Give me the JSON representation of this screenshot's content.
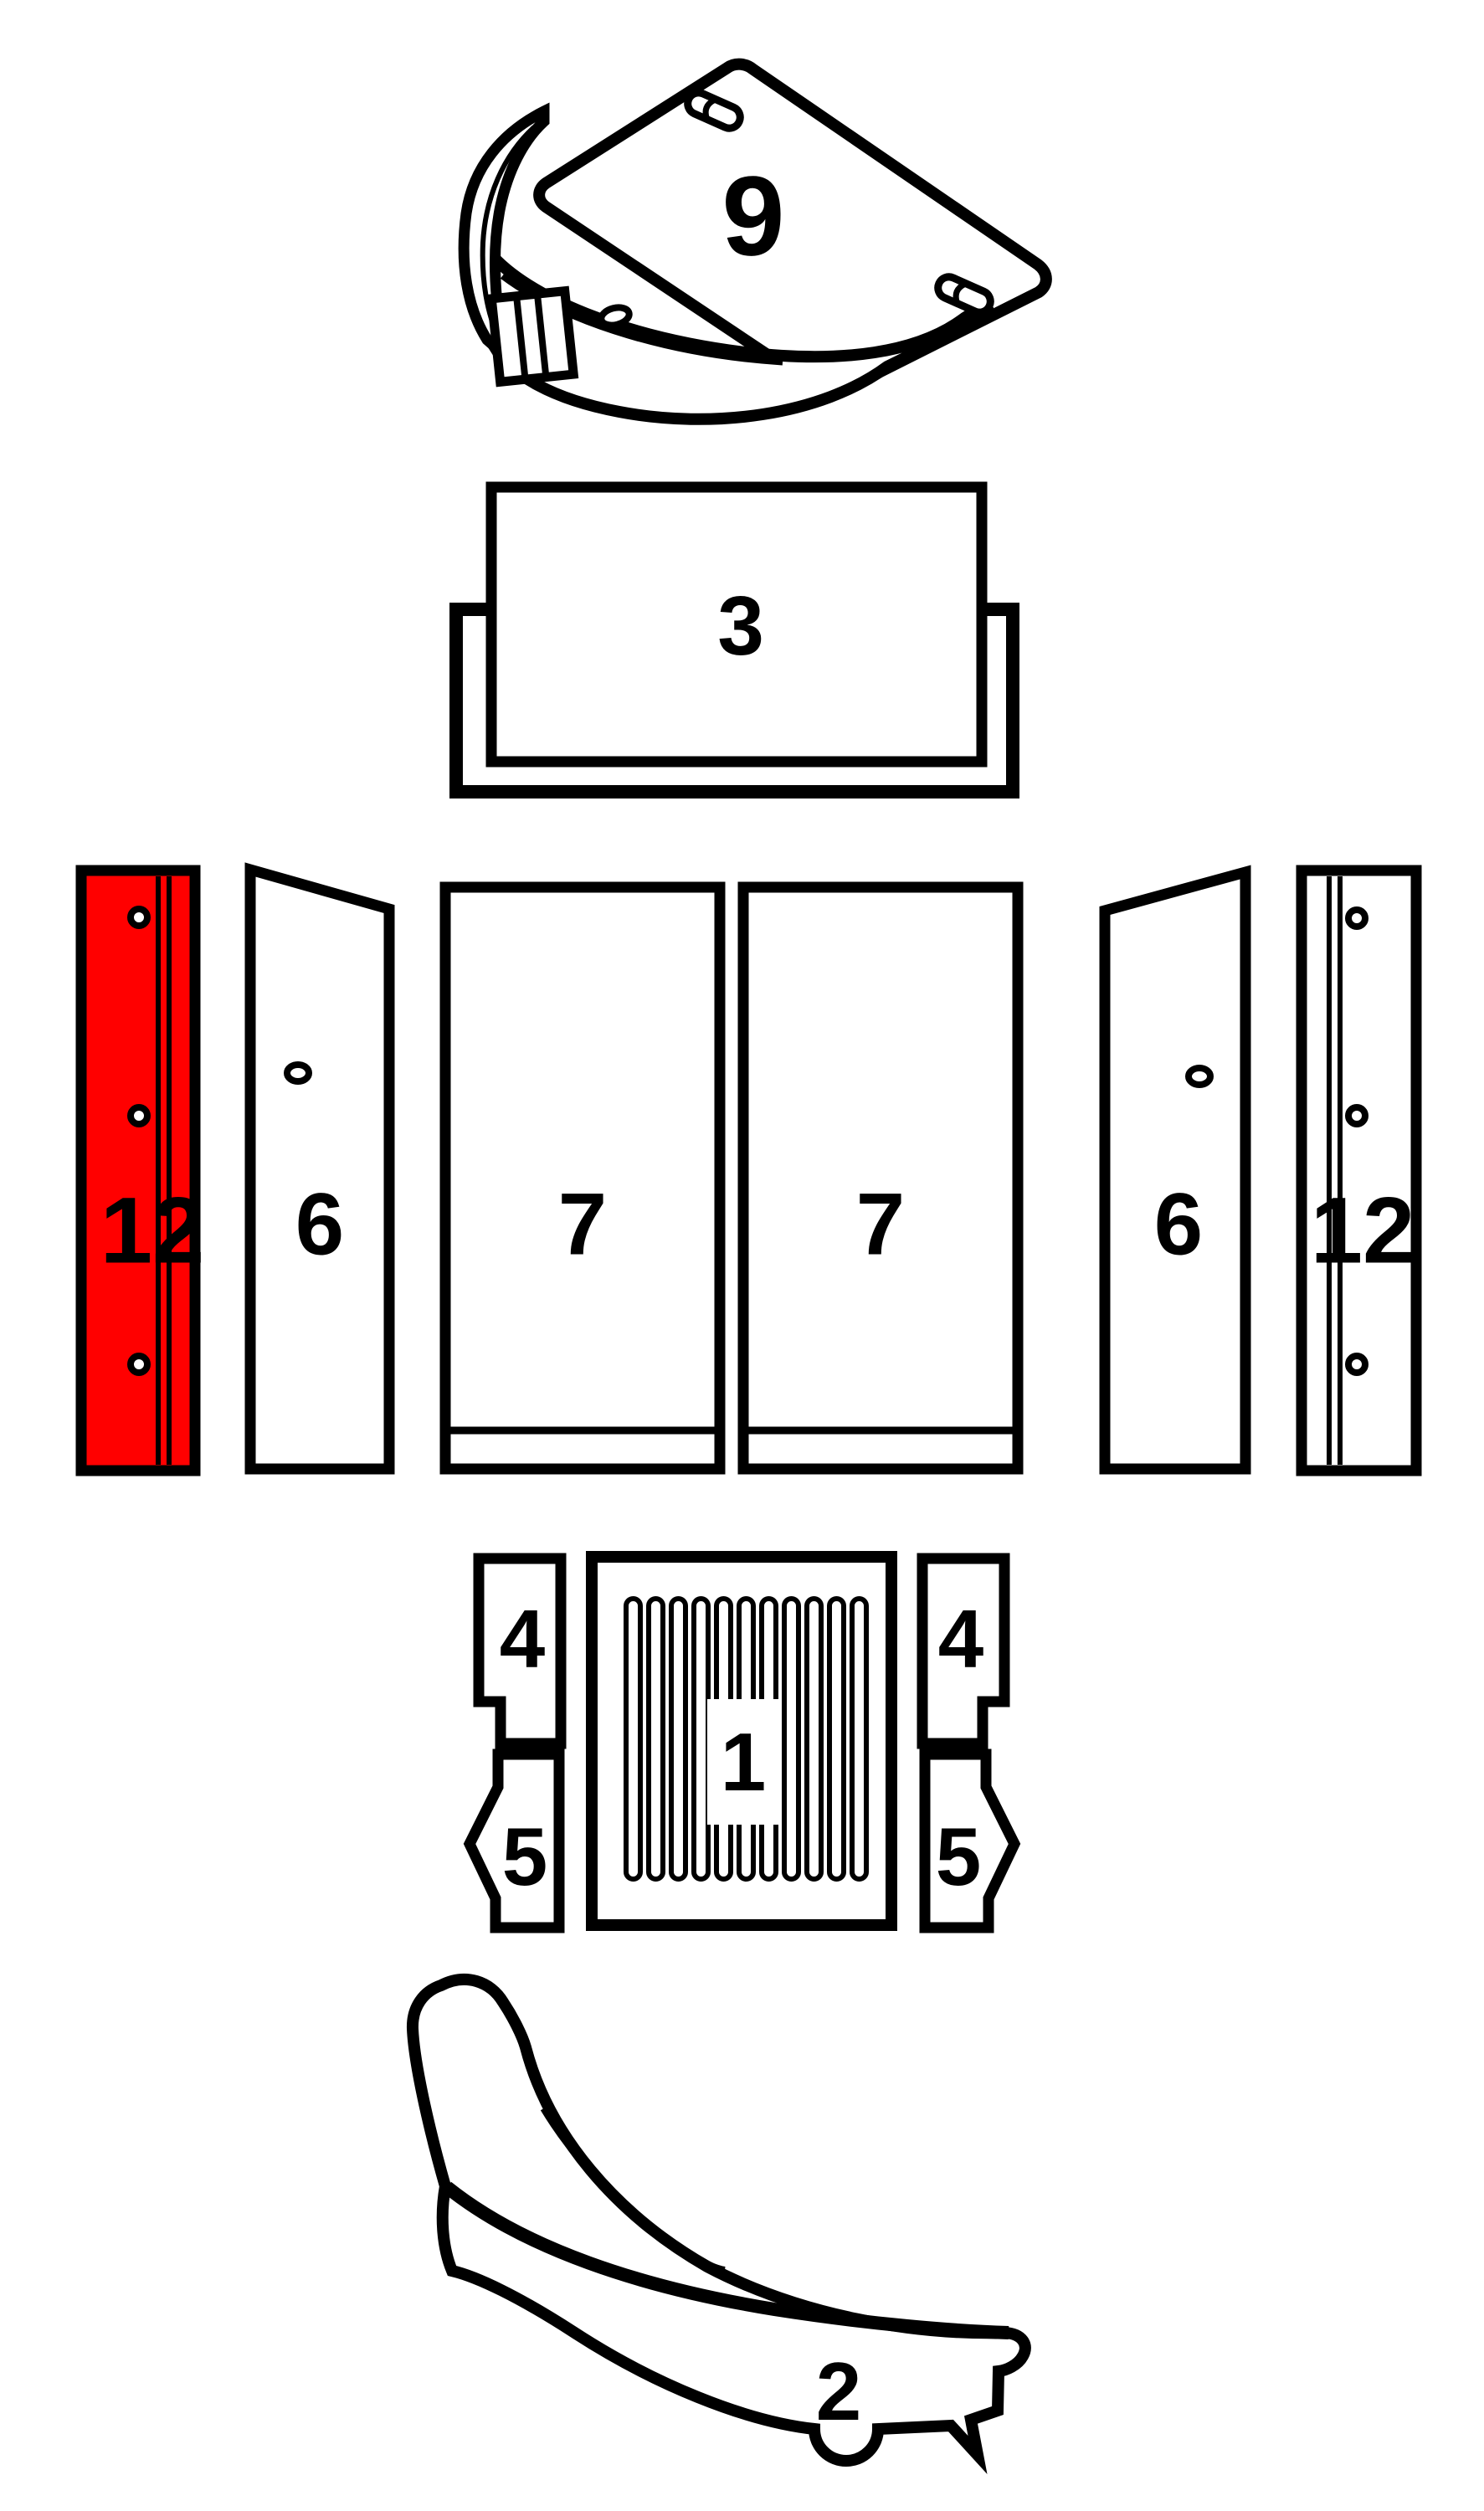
{
  "diagram": {
    "kind": "exploded-parts-diagram",
    "background": "#ffffff",
    "line_color": "#000000",
    "highlight_color": "#ff0000",
    "selected_part": "12",
    "parts": [
      {
        "id": "part9",
        "label": "9",
        "highlighted": false
      },
      {
        "id": "part3",
        "label": "3",
        "highlighted": false
      },
      {
        "id": "part12_left",
        "label": "12",
        "highlighted": true
      },
      {
        "id": "part6_left",
        "label": "6",
        "highlighted": false
      },
      {
        "id": "part7_left",
        "label": "7",
        "highlighted": false
      },
      {
        "id": "part7_right",
        "label": "7",
        "highlighted": false
      },
      {
        "id": "part6_right",
        "label": "6",
        "highlighted": false
      },
      {
        "id": "part12_right",
        "label": "12",
        "highlighted": false
      },
      {
        "id": "part4_left",
        "label": "4",
        "highlighted": false
      },
      {
        "id": "part1",
        "label": "1",
        "highlighted": false
      },
      {
        "id": "part4_right",
        "label": "4",
        "highlighted": false
      },
      {
        "id": "part5_left",
        "label": "5",
        "highlighted": false
      },
      {
        "id": "part5_right",
        "label": "5",
        "highlighted": false
      },
      {
        "id": "part2",
        "label": "2",
        "highlighted": false
      }
    ],
    "labels": {
      "part9": "9",
      "part3": "3",
      "part12_left": "12",
      "part6_left": "6",
      "part7_left": "7",
      "part7_right": "7",
      "part6_right": "6",
      "part12_right": "12",
      "part4_left": "4",
      "part1": "1",
      "part4_right": "4",
      "part5_left": "5",
      "part5_right": "5",
      "part2": "2"
    }
  }
}
